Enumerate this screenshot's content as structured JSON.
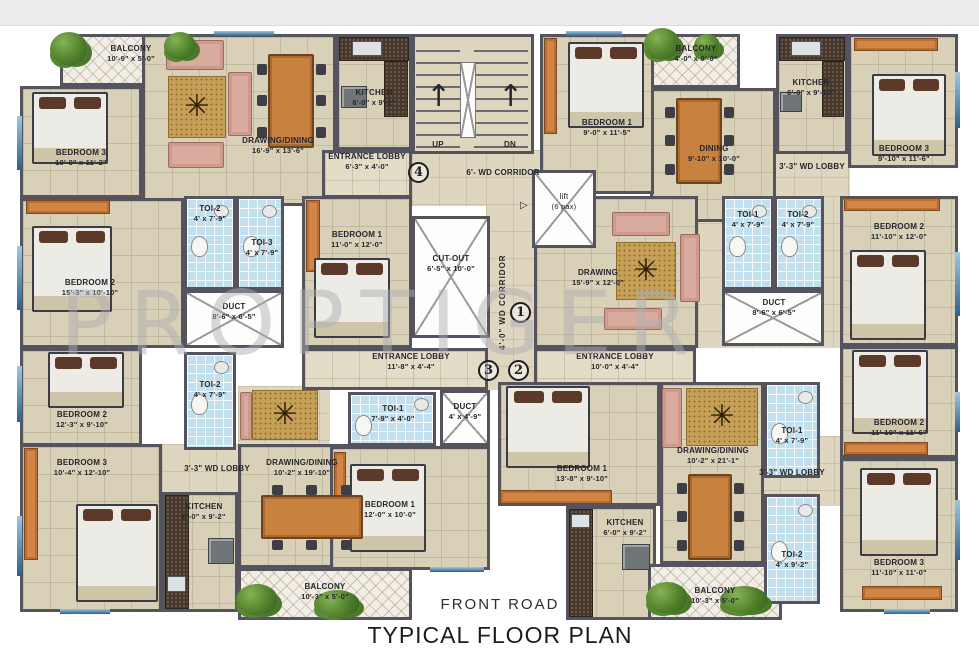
{
  "page": {
    "title": "TYPICAL FLOOR PLAN",
    "road": "FRONT ROAD",
    "watermark": "PROPTIGER"
  },
  "stairwell": {
    "up": "UP",
    "dn": "DN",
    "up_arrow": "↑",
    "dn_arrow": "↑",
    "corridor_h": "6'-  WD CORRIDOR",
    "corridor_v": "4'-0\" WD CORRIDOR",
    "lift": "lift",
    "lift_cap": "(6 pax)",
    "lift_door": "▷"
  },
  "units": [
    "1",
    "2",
    "3",
    "4"
  ],
  "rooms": {
    "balcony_tl": {
      "label": "BALCONY",
      "dims": "10'-9\" x 5'-0\""
    },
    "bedroom3_tl": {
      "label": "BEDROOM 3",
      "dims": "10'-0\" x 11'-2\""
    },
    "drawing_tl": {
      "label": "DRAWING/DINING",
      "dims": "16'-9\" x 13'-6\""
    },
    "kitchen_tl": {
      "label": "KITCHEN",
      "dims": "6'-0\" x 9'-2\""
    },
    "entrance_tl": {
      "label": "ENTRANCE LOBBY",
      "dims": "6'-3\" x 4'-0\""
    },
    "bedroom2_tl": {
      "label": "BEDROOM 2",
      "dims": "15'-3\" x 10'-10\""
    },
    "toi2_tl": {
      "label": "TOI-2",
      "dims": "4' x 7'-9\""
    },
    "toi3_tl": {
      "label": "TOI-3",
      "dims": "4' x 7'-9\""
    },
    "duct_l": {
      "label": "DUCT",
      "dims": "8'-6\" x 6'-5\""
    },
    "bedroom1_ctl": {
      "label": "BEDROOM 1",
      "dims": "11'-0\" x 12'-0\""
    },
    "cutout": {
      "label": "CUT-OUT",
      "dims": "6'-5\" x 10'-0\""
    },
    "bedroom2_bl": {
      "label": "BEDROOM 2",
      "dims": "12'-3\" x 9'-10\""
    },
    "toi2_bl": {
      "label": "TOI-2",
      "dims": "4' x 7'-9\""
    },
    "bedroom3_bl": {
      "label": "BEDROOM 3",
      "dims": "10'-4\" x 12'-10\""
    },
    "wdlobby_bl": {
      "label": "3'-3\" WD LOBBY"
    },
    "kitchen_bl": {
      "label": "KITCHEN",
      "dims": "6'-0\" x 9'-2\""
    },
    "drawing_bl": {
      "label": "DRAWING/DINING",
      "dims": "10'-2\" x 19'-10\""
    },
    "toi1_bl": {
      "label": "TOI-1",
      "dims": "7'-9\" x 4'-0\""
    },
    "duct_c": {
      "label": "DUCT",
      "dims": "4' x 4'-9\""
    },
    "bedroom1_bl": {
      "label": "BEDROOM 1",
      "dims": "12'-0\" x 10'-0\""
    },
    "balcony_bl": {
      "label": "BALCONY",
      "dims": "10'-3\" x 5'-0\""
    },
    "entrance_bl": {
      "label": "ENTRANCE LOBBY",
      "dims": "11'-8\" x 4'-4\""
    },
    "entrance_tr": {
      "label": "ENTRANCE LOBBY",
      "dims": "10'-0\" x 4'-4\""
    },
    "balcony_tr": {
      "label": "BALCONY",
      "dims": "4'-0\" x 9'-0\""
    },
    "dining_tr": {
      "label": "DINING",
      "dims": "9'-10\" x 10'-0\""
    },
    "kitchen_tr": {
      "label": "KITCHEN",
      "dims": "6'-0\" x 9'-10\""
    },
    "bedroom1_tr": {
      "label": "BEDROOM 1",
      "dims": "9'-0\" x 11'-5\""
    },
    "bedroom3_tr": {
      "label": "BEDROOM 3",
      "dims": "9'-10\" x 11'-6\""
    },
    "wdlobby_tr": {
      "label": "3'-3\" WD LOBBY"
    },
    "drawing_tr": {
      "label": "DRAWING",
      "dims": "15'-9\" x 12'-0\""
    },
    "toi1_tr": {
      "label": "TOI-1",
      "dims": "4' x 7'-9\""
    },
    "toi2_tr": {
      "label": "TOI-2",
      "dims": "4' x 7'-9\""
    },
    "duct_r": {
      "label": "DUCT",
      "dims": "8'-6\" x 6'-5\""
    },
    "bedroom2_tr": {
      "label": "BEDROOM 2",
      "dims": "11'-10\" x 12'-0\""
    },
    "bedroom1_br": {
      "label": "BEDROOM 1",
      "dims": "13'-8\" x 9'-10\""
    },
    "kitchen_br": {
      "label": "KITCHEN",
      "dims": "6'-0\" x 9'-2\""
    },
    "drawing_br": {
      "label": "DRAWING/DINING",
      "dims": "10'-2\" x 21'-1\""
    },
    "balcony_br": {
      "label": "BALCONY",
      "dims": "10'-3\" x 5'-0\""
    },
    "toi1_br": {
      "label": "TOI-1",
      "dims": "4' x 7'-9\""
    },
    "wdlobby_br": {
      "label": "3'-3\" WD LOBBY"
    },
    "toi2_br": {
      "label": "TOI-2",
      "dims": "4' x 9'-2\""
    },
    "bedroom2_br": {
      "label": "BEDROOM 2",
      "dims": "11'-10\" x 11'-6\""
    },
    "bedroom3_br": {
      "label": "BEDROOM 3",
      "dims": "11'-10\" x 11'-0\""
    }
  }
}
